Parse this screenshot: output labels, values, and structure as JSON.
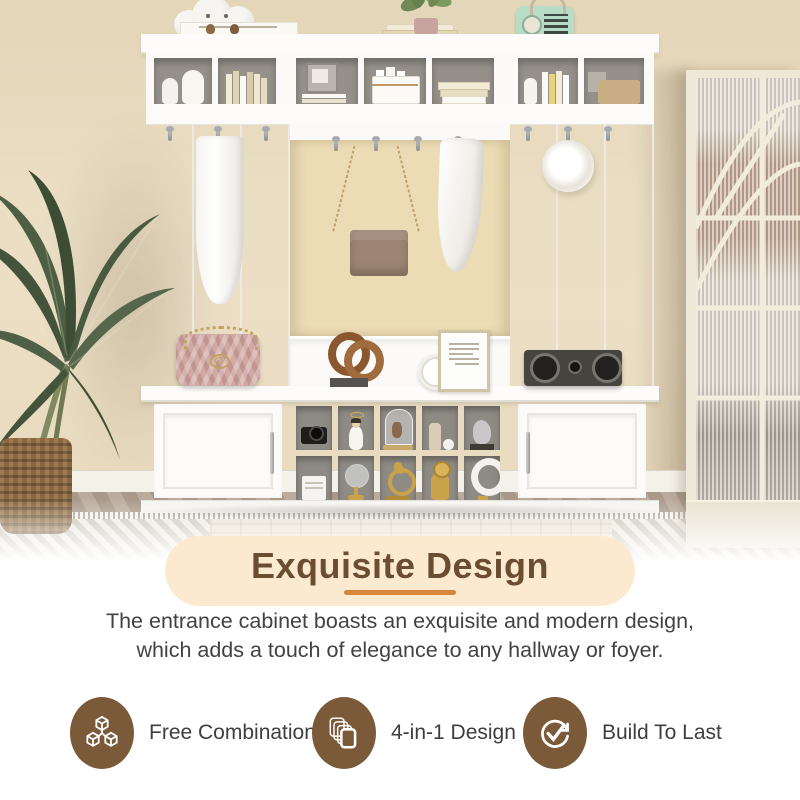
{
  "title_section": {
    "title": "Exquisite Design",
    "title_color": "#6b4d31",
    "box_color": "#fce9cd",
    "underline_color": "#d8873a"
  },
  "description": {
    "line1": "The entrance cabinet boasts an exquisite and modern design,",
    "line2": "which adds a touch of elegance to any hallway or foyer."
  },
  "features": [
    {
      "icon": "cubes-icon",
      "label": "Free Combination"
    },
    {
      "icon": "layers-icon",
      "label": "4-in-1 Design"
    },
    {
      "icon": "check-cycle-icon",
      "label": "Build To Last"
    }
  ],
  "colors": {
    "feature_circle": "#7b5a39",
    "feature_label": "#3e3e3e",
    "body_text": "#424242",
    "wall_beige": "#e9dcc1",
    "alcove_beige": "#ecdcb5",
    "furniture_white": "#fcfbfa"
  },
  "scene": {
    "subject": "white 4-in-1 hall tree entryway cabinet with hooks, shelves, bench cabinets and display cubbies",
    "setting": "beige hallway with palm plant in woven basket, patterned rug, wood floor and fluted-glass arched door"
  }
}
